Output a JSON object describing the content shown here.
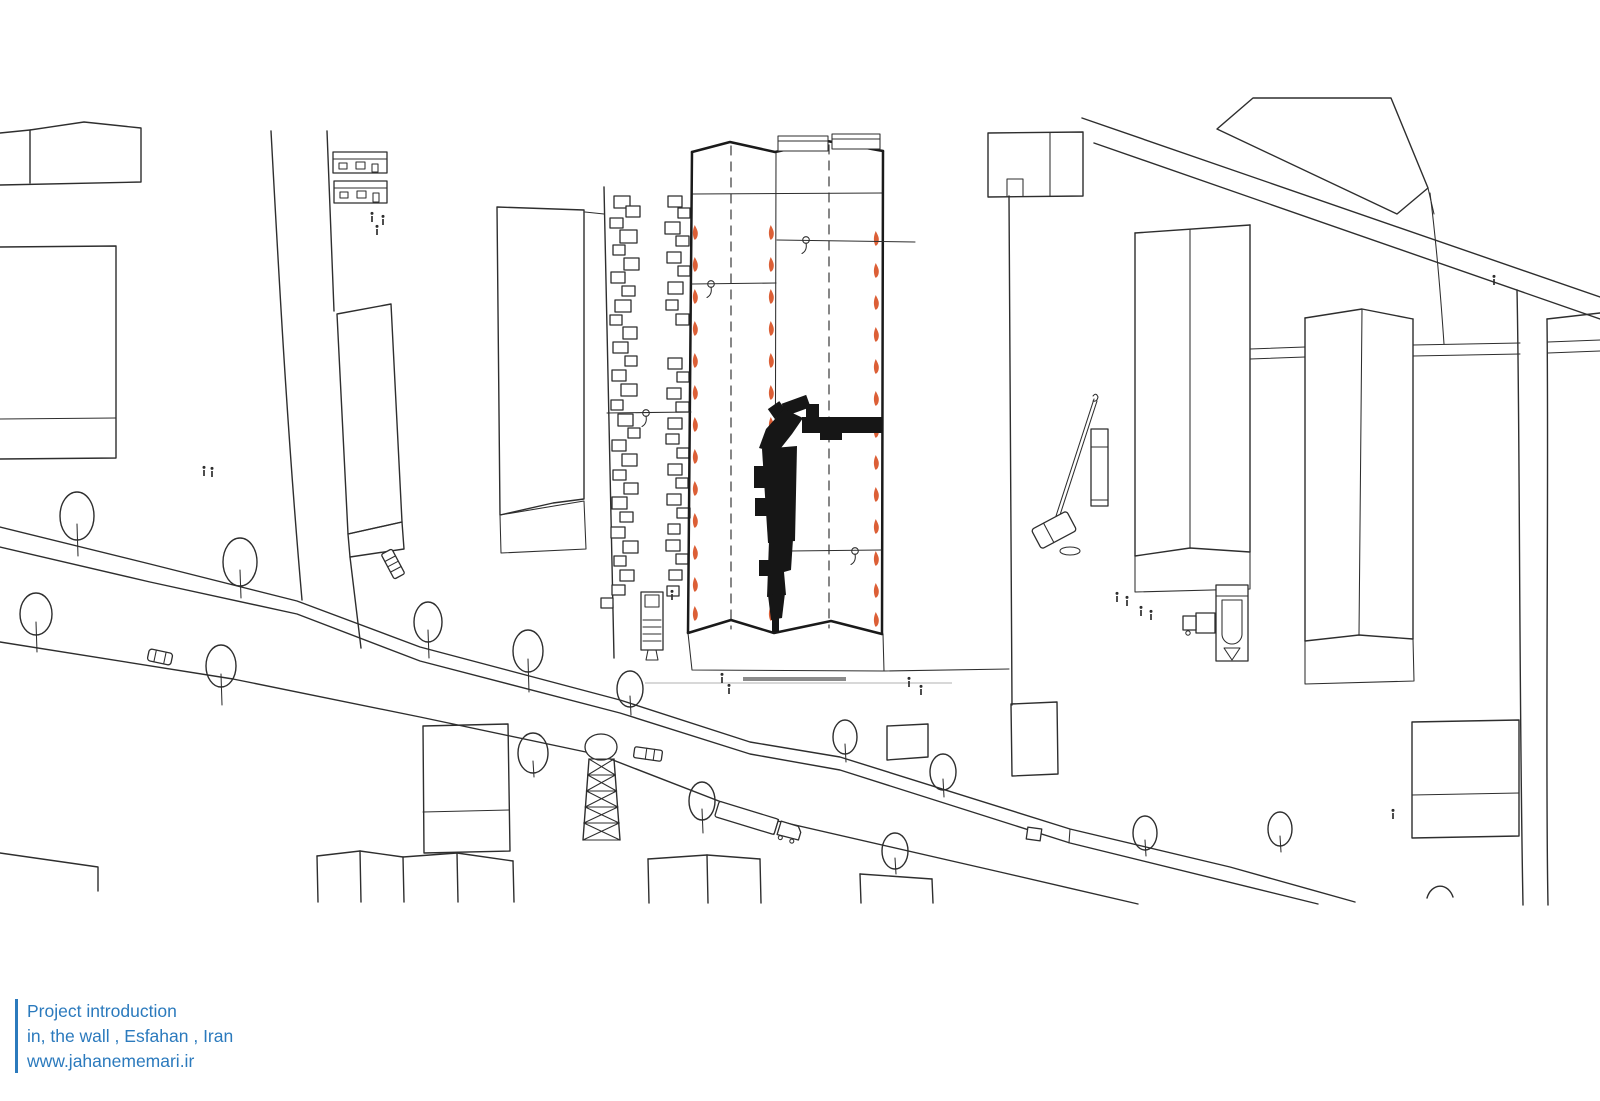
{
  "caption": {
    "line1": "Project introduction",
    "line2": "in, the wall , Esfahan , Iran",
    "line3": "www.jahanememari.ir",
    "text_color": "#2b7abd",
    "bar_color": "#2b7abd"
  },
  "palette": {
    "background": "#ffffff",
    "ink": "#2e2e2e",
    "site_edge": "#1a1a1a",
    "orange_marker": "#dc5f36",
    "built_mass": "#161616",
    "scale_bar_gray": "#8b8b8b",
    "faint_line_gray": "#cccccc"
  },
  "drawing": {
    "type": "hand-drawn architectural site plan, top view",
    "site": {
      "fold_panels": 2,
      "dashed_axis_lines": 2,
      "orange_tick_rows": 3,
      "orange_ticks_per_row": 13,
      "anchor_callouts": 4,
      "built_mass_shape": "L-shaped black volume",
      "debris_columns": 2
    },
    "context": {
      "trees": 15,
      "pedestrians": 16,
      "vehicles": [
        "sedan",
        "delivery-van",
        "pickup-truck",
        "ladder-truck",
        "semi-trailer-truck",
        "mobile-crane",
        "concrete-mixer-truck",
        "service-truck",
        "cargo-box"
      ],
      "structures": [
        "lattice-mast",
        "scale-bar",
        "roads",
        "city-blocks"
      ]
    }
  }
}
